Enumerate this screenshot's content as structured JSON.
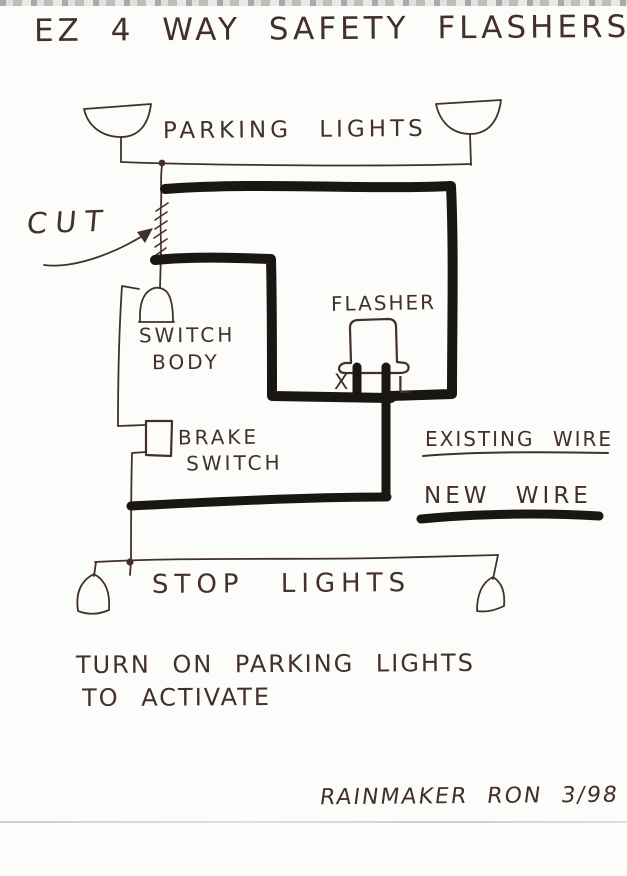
{
  "title": "EZ 4 WAY SAFETY FLASHERS",
  "labels": {
    "parking_lights": "PARKING LIGHTS",
    "cut": "CUT",
    "switch_body": [
      "SWITCH",
      "BODY"
    ],
    "flasher": "FLASHER",
    "terminal_x": "X",
    "terminal_l": "L",
    "brake_switch": [
      "BRAKE",
      "SWITCH"
    ],
    "stop_lights": "STOP LIGHTS"
  },
  "legend": {
    "existing_wire": "EXISTING WIRE",
    "new_wire": "NEW WIRE"
  },
  "note": [
    "TURN ON PARKING LIGHTS",
    "TO ACTIVATE"
  ],
  "signature": "RAINMAKER RON 3/98",
  "colors": {
    "ink": "#43302a",
    "thick_wire": "#1a1613",
    "paper": "#fcfcfa"
  }
}
